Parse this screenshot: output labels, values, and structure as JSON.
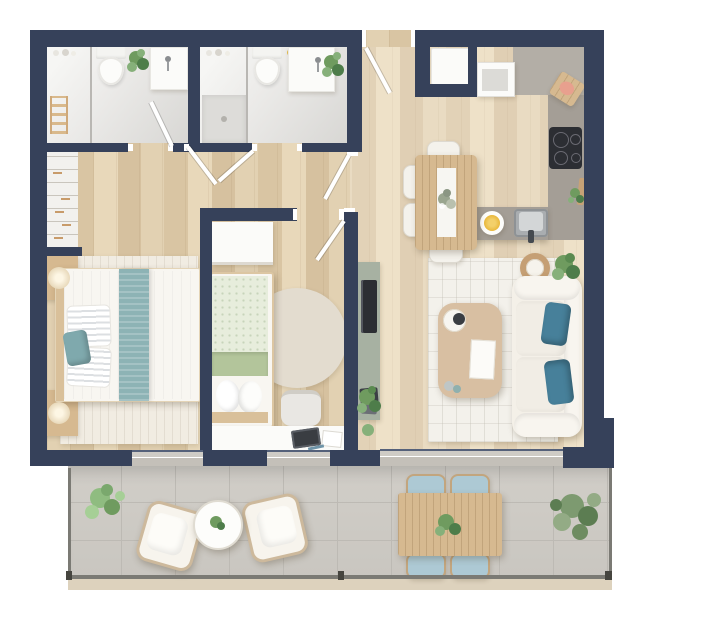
{
  "title": "two-bedroom-apartment-floor-plan",
  "palette": {
    "wall": "#36415A",
    "wood_a": "#E2D1B2",
    "wood_b": "#D9C5A3",
    "wood_c": "#E8D8BA",
    "wood_d": "#D6C19F",
    "bath": "#EBEAE8",
    "tile_a": "#C9C6C0",
    "tile_line": "#BDBAB4",
    "glass": "#C7C3BC",
    "counter_light": "#B3AEA6",
    "counter_dark": "#A49E96",
    "cream": "#F4F0E8",
    "rug": "#F3F1EB",
    "teal": "#47809A",
    "teal_light": "#8DB3B5",
    "furn_wood": "#D6B990",
    "sage": "#A7B1A2",
    "outdoor_cushion": "#ADC9D4",
    "railing": "#7B7A74",
    "beige_edge": "#DDD2BD",
    "plant_a": "#6F9B5F",
    "plant_b": "#4E7D4A",
    "tv_dark": "#2C2E33",
    "white": "#FBFBF9"
  },
  "rooms": [
    {
      "id": "bathroom-ensuite",
      "label": "ensuite bathroom",
      "furniture": [
        "toilet",
        "vanity-sink",
        "shower",
        "towel-ladder",
        "plant",
        "door"
      ]
    },
    {
      "id": "bathroom-2",
      "label": "second bathroom",
      "furniture": [
        "toilet",
        "vanity-sink",
        "shower-enclosure",
        "plant",
        "door"
      ]
    },
    {
      "id": "bedroom-1",
      "label": "master bedroom",
      "furniture": [
        "double-bed",
        "teal-bed-runner",
        "striped-pillows",
        "nightstand-top",
        "nightstand-bottom",
        "table-lamps",
        "open-wardrobe-rails",
        "area-rug"
      ]
    },
    {
      "id": "bedroom-2",
      "label": "second bedroom",
      "furniture": [
        "single-bed",
        "wardrobe",
        "round-rug",
        "desk",
        "desk-chair",
        "door"
      ]
    },
    {
      "id": "hallway",
      "label": "entrance hall and corridor",
      "furniture": [
        "entrance-door",
        "corridor-door",
        "bedroom-door"
      ]
    },
    {
      "id": "kitchen",
      "label": "kitchen",
      "furniture": [
        "tall-unit",
        "appliance-cabinet",
        "l-shaped-counter",
        "cooktop",
        "sink",
        "cutting-board",
        "serving-bowl",
        "herb-plant"
      ]
    },
    {
      "id": "dining",
      "label": "dining area",
      "furniture": [
        "dining-table",
        "table-runner",
        "flower-centerpiece",
        "dining-chairs-x4"
      ]
    },
    {
      "id": "living",
      "label": "living area",
      "furniture": [
        "sofa",
        "teal-cushions-x2",
        "coffee-table",
        "area-rug",
        "media-bench",
        "tv",
        "side-table",
        "floor-plant"
      ]
    },
    {
      "id": "terrace",
      "label": "terrace",
      "furniture": [
        "lounge-chairs-x2",
        "round-coffee-table",
        "outdoor-dining-table",
        "outdoor-chairs-x4",
        "potted-plants",
        "glass-railing"
      ]
    }
  ]
}
